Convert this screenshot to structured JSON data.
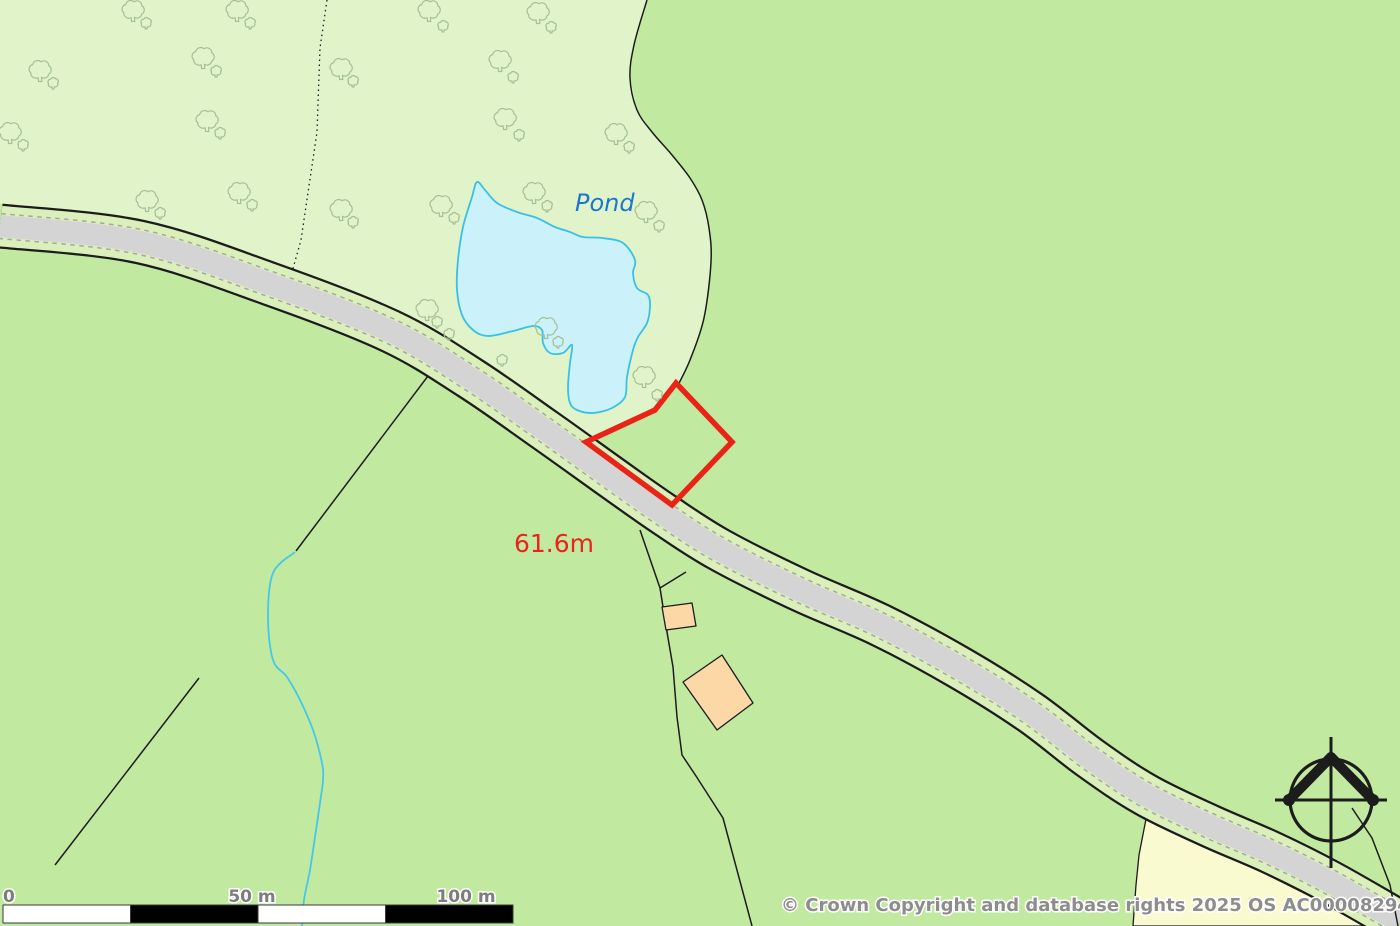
{
  "labels": {
    "pond": "Pond",
    "elevation": "61.6m",
    "copyright": "© Crown Copyright and database rights 2025 OS AC0000829429",
    "scale": {
      "zero": "0",
      "fifty": "50 m",
      "hundred": "100 m"
    }
  },
  "colors": {
    "base_green": "#c2e9a0",
    "woodland_green": "#e1f4c9",
    "verge_green": "#daefba",
    "road_gray": "#d5d4d5",
    "road_dash": "#a6a6a6",
    "line_black": "#1c1c1c",
    "pond_fill": "#cbf2fb",
    "pond_edge": "#3ac0e8",
    "stream": "#44c8e8",
    "cream_field": "#fafad0",
    "plot_red": "#ea2318",
    "building_fill": "#fbd8a5",
    "tree_stroke": "#a5bf97",
    "label_blue": "#1b76cf",
    "label_red": "#e8251c",
    "label_gray": "#8d8d8d"
  },
  "geometry": {
    "roadCenter": [
      [
        0,
        226
      ],
      [
        140,
        242
      ],
      [
        270,
        284
      ],
      [
        390,
        331
      ],
      [
        470,
        378
      ],
      [
        545,
        430
      ],
      [
        615,
        480
      ],
      [
        665,
        515
      ],
      [
        720,
        550
      ],
      [
        800,
        590
      ],
      [
        880,
        625
      ],
      [
        960,
        668
      ],
      [
        1030,
        712
      ],
      [
        1090,
        758
      ],
      [
        1146,
        795
      ],
      [
        1210,
        826
      ],
      [
        1270,
        852
      ],
      [
        1330,
        882
      ],
      [
        1400,
        922
      ]
    ],
    "woodland": [
      [
        0,
        0
      ],
      [
        647,
        0
      ],
      [
        634,
        45
      ],
      [
        630,
        78
      ],
      [
        637,
        110
      ],
      [
        652,
        132
      ],
      [
        672,
        155
      ],
      [
        690,
        178
      ],
      [
        702,
        200
      ],
      [
        709,
        228
      ],
      [
        711,
        262
      ],
      [
        704,
        318
      ],
      [
        690,
        360
      ],
      [
        677,
        387
      ],
      [
        655,
        410
      ],
      [
        586,
        442
      ],
      [
        545,
        408
      ],
      [
        470,
        356
      ],
      [
        390,
        309
      ],
      [
        270,
        262
      ],
      [
        140,
        220
      ],
      [
        0,
        204
      ]
    ],
    "curveD": [
      [
        647,
        0
      ],
      [
        634,
        45
      ],
      [
        630,
        78
      ],
      [
        637,
        110
      ],
      [
        652,
        132
      ],
      [
        672,
        155
      ],
      [
        690,
        178
      ],
      [
        702,
        200
      ],
      [
        709,
        228
      ],
      [
        711,
        262
      ],
      [
        704,
        318
      ],
      [
        690,
        360
      ],
      [
        677,
        387
      ]
    ],
    "pond": [
      [
        477,
        182
      ],
      [
        472,
        197
      ],
      [
        463,
        227
      ],
      [
        458,
        260
      ],
      [
        457,
        290
      ],
      [
        462,
        315
      ],
      [
        473,
        330
      ],
      [
        488,
        336
      ],
      [
        513,
        331
      ],
      [
        533,
        326
      ],
      [
        542,
        330
      ],
      [
        543,
        343
      ],
      [
        550,
        353
      ],
      [
        563,
        353
      ],
      [
        572,
        345
      ],
      [
        570,
        363
      ],
      [
        568,
        387
      ],
      [
        570,
        403
      ],
      [
        577,
        410
      ],
      [
        593,
        413
      ],
      [
        612,
        408
      ],
      [
        625,
        397
      ],
      [
        627,
        377
      ],
      [
        633,
        350
      ],
      [
        638,
        337
      ],
      [
        647,
        323
      ],
      [
        650,
        307
      ],
      [
        648,
        295
      ],
      [
        637,
        288
      ],
      [
        633,
        273
      ],
      [
        635,
        260
      ],
      [
        623,
        243
      ],
      [
        602,
        238
      ],
      [
        583,
        237
      ],
      [
        570,
        232
      ],
      [
        555,
        227
      ],
      [
        537,
        218
      ],
      [
        517,
        212
      ],
      [
        497,
        203
      ],
      [
        485,
        190
      ]
    ],
    "redPlot": [
      [
        676,
        383
      ],
      [
        732,
        442
      ],
      [
        672,
        505
      ],
      [
        586,
        442
      ],
      [
        655,
        410
      ]
    ],
    "stream": [
      [
        295,
        552
      ],
      [
        273,
        573
      ],
      [
        268,
        617
      ],
      [
        273,
        660
      ],
      [
        287,
        677
      ],
      [
        300,
        700
      ],
      [
        313,
        730
      ],
      [
        322,
        763
      ],
      [
        323,
        780
      ],
      [
        320,
        803
      ],
      [
        315,
        837
      ],
      [
        310,
        870
      ],
      [
        304,
        900
      ],
      [
        302,
        926
      ]
    ],
    "dottedBoundary": [
      [
        327,
        0
      ],
      [
        320,
        48
      ],
      [
        317,
        132
      ],
      [
        301,
        240
      ],
      [
        292,
        272
      ]
    ],
    "boundaries": [
      [
        [
          428,
          376
        ],
        [
          296,
          551
        ]
      ],
      [
        [
          199,
          678
        ],
        [
          55,
          865
        ]
      ],
      [
        [
          640,
          530
        ],
        [
          660,
          588
        ],
        [
          667,
          632
        ],
        [
          673,
          667
        ],
        [
          677,
          717
        ],
        [
          682,
          755
        ],
        [
          696,
          776
        ],
        [
          723,
          818
        ],
        [
          752,
          926
        ]
      ],
      [
        [
          660,
          588
        ],
        [
          686,
          572
        ]
      ],
      [
        [
          1352,
          808
        ],
        [
          1372,
          838
        ],
        [
          1390,
          885
        ],
        [
          1398,
          926
        ]
      ]
    ],
    "cream": [
      [
        1146,
        819
      ],
      [
        1200,
        845
      ],
      [
        1260,
        871
      ],
      [
        1320,
        901
      ],
      [
        1360,
        922
      ],
      [
        1373,
        926
      ],
      [
        1133,
        926
      ],
      [
        1136,
        885
      ],
      [
        1139,
        855
      ]
    ],
    "buildings": [
      [
        [
          662,
          607
        ],
        [
          692,
          603
        ],
        [
          696,
          626
        ],
        [
          666,
          630
        ]
      ],
      [
        [
          683,
          682
        ],
        [
          722,
          655
        ],
        [
          753,
          703
        ],
        [
          717,
          730
        ]
      ]
    ],
    "treesBig": [
      [
        133,
        10
      ],
      [
        237,
        10
      ],
      [
        40,
        70
      ],
      [
        203,
        57
      ],
      [
        10,
        132
      ],
      [
        207,
        120
      ],
      [
        147,
        200
      ],
      [
        239,
        192
      ],
      [
        341,
        68
      ],
      [
        341,
        209
      ],
      [
        429,
        10
      ],
      [
        538,
        12
      ],
      [
        500,
        60
      ],
      [
        505,
        118
      ],
      [
        616,
        133
      ],
      [
        534,
        192
      ],
      [
        646,
        211
      ],
      [
        441,
        205
      ],
      [
        427,
        309
      ],
      [
        546,
        327
      ],
      [
        644,
        376
      ]
    ],
    "treesSmall": [
      [
        146,
        23
      ],
      [
        250,
        23
      ],
      [
        53,
        83
      ],
      [
        216,
        71
      ],
      [
        23,
        145
      ],
      [
        220,
        133
      ],
      [
        160,
        213
      ],
      [
        252,
        205
      ],
      [
        353,
        81
      ],
      [
        353,
        222
      ],
      [
        443,
        26
      ],
      [
        551,
        27
      ],
      [
        513,
        77
      ],
      [
        519,
        135
      ],
      [
        629,
        147
      ],
      [
        547,
        206
      ],
      [
        659,
        226
      ],
      [
        454,
        218
      ],
      [
        437,
        322
      ],
      [
        449,
        334
      ],
      [
        502,
        360
      ],
      [
        558,
        342
      ],
      [
        657,
        395
      ]
    ],
    "compass": {
      "cx": 1331,
      "cy": 800,
      "r": 41
    },
    "scalebar": {
      "x": 3,
      "y": 905,
      "height": 18,
      "segmentWidth": 127.5,
      "segments": [
        "white",
        "black",
        "white",
        "black"
      ]
    }
  }
}
